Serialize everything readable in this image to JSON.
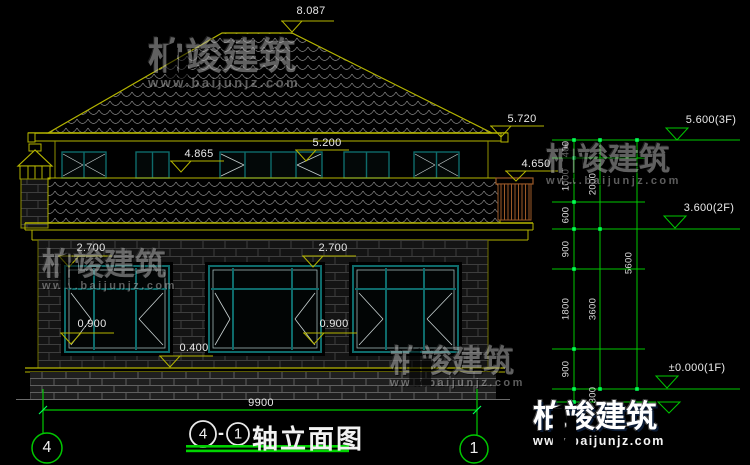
{
  "title": {
    "axis_start": "4",
    "dash": "-",
    "axis_end": "1",
    "name": "轴立面图"
  },
  "axis_bubbles": {
    "left": "4",
    "right": "1"
  },
  "levels": {
    "ridge": "8.087",
    "eave": "5.720",
    "upper_window_top": "5.200",
    "upper_sill": "4.865",
    "balcony": "4.650",
    "floor3": "5.600(3F)",
    "floor2": "3.600(2F)",
    "floor1": "±0.000(1F)",
    "lintel_left": "2.700",
    "lintel_right": "2.700",
    "sill_left": "0.900",
    "sill_right": "0.900",
    "plinth": "0.400"
  },
  "dimensions": {
    "total_width": "9900",
    "chain_inner": [
      "400",
      "1000",
      "600",
      "900",
      "1800",
      "900",
      "300"
    ],
    "chain_mid": [
      "2000",
      "3600"
    ],
    "chain_outer": [
      "5600"
    ]
  },
  "watermark": {
    "brand": "柏竣建筑",
    "url": "www.baijunjz.com"
  },
  "colors": {
    "line_green": "#00c800",
    "tick_green": "#00ff55",
    "line_yellow": "#b5b500",
    "window_teal": "#0e6b6b",
    "railing_brown": "#9c5a28"
  }
}
